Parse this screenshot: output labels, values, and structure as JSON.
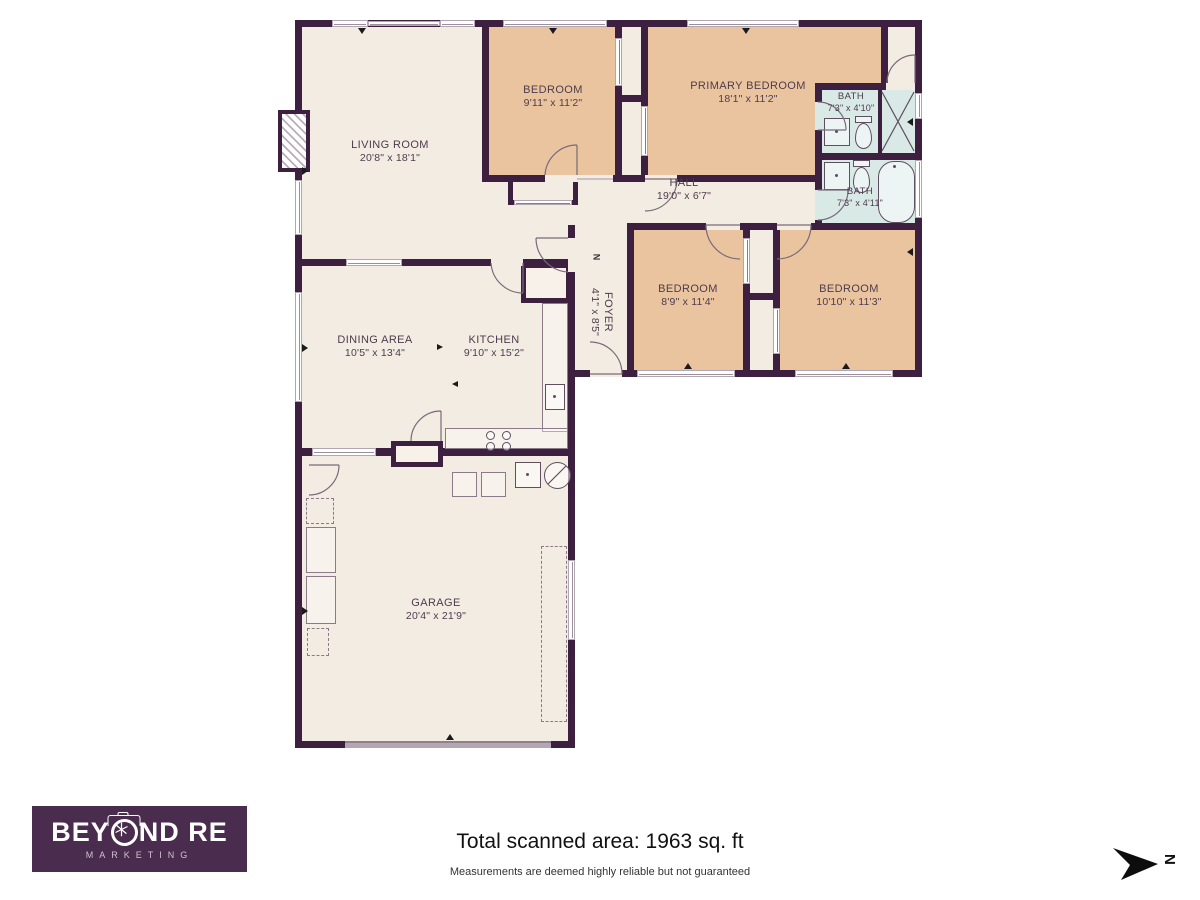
{
  "rooms": {
    "living": {
      "name": "LIVING ROOM",
      "dims": "20'8\" x 18'1\""
    },
    "bedroom_top": {
      "name": "BEDROOM",
      "dims": "9'11\" x 11'2\""
    },
    "primary": {
      "name": "PRIMARY BEDROOM",
      "dims": "18'1\" x 11'2\""
    },
    "bath_top": {
      "name": "BATH",
      "dims": "7'3\" x 4'10\""
    },
    "bath_bottom": {
      "name": "BATH",
      "dims": "7'3\" x 4'11\""
    },
    "hall": {
      "name": "HALL",
      "dims": "19'0\" x 6'7\""
    },
    "foyer": {
      "name": "FOYER",
      "dims": "4'1\" x 8'5\""
    },
    "bedroom_mid": {
      "name": "BEDROOM",
      "dims": "8'9\" x 11'4\""
    },
    "bedroom_right": {
      "name": "BEDROOM",
      "dims": "10'10\" x 11'3\""
    },
    "dining": {
      "name": "DINING AREA",
      "dims": "10'5\" x 13'4\""
    },
    "kitchen": {
      "name": "KITCHEN",
      "dims": "9'10\" x 15'2\""
    },
    "garage": {
      "name": "GARAGE",
      "dims": "20'4\" x 21'9\""
    }
  },
  "compass": {
    "north_label": "N"
  },
  "branding": {
    "name_prefix": "BEY",
    "name_suffix": "ND RE",
    "tagline": "MARKETING"
  },
  "footer": {
    "total_area": "Total scanned area: 1963 sq. ft",
    "disclaimer": "Measurements are deemed highly reliable but not guaranteed"
  },
  "colors": {
    "wall": "#3d2040",
    "floor": "#f3ece2",
    "bedroom": "#eac49f",
    "bath": "#d8e9e6",
    "logo_bg": "#4a2c4e",
    "arrow": "#0d0d0d"
  }
}
